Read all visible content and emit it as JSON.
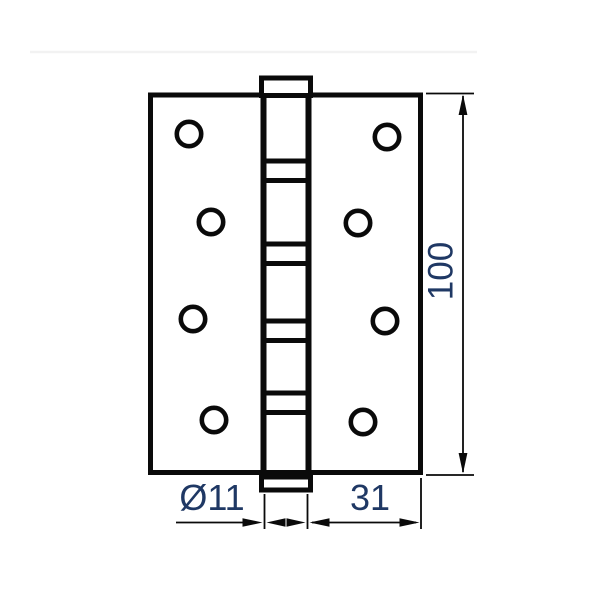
{
  "drawing": {
    "kind": "technical dimension drawing",
    "colors": {
      "background": "#ffffff",
      "ink": "#0a0a0a",
      "label": "#1f3864",
      "faint_divider": "#f2f2f2"
    },
    "dimension_labels": {
      "height": "100",
      "barrel_diameter": "Ø11",
      "leaf_width": "31"
    },
    "screw_holes": [
      [
        189,
        134
      ],
      [
        211,
        222
      ],
      [
        193,
        319
      ],
      [
        214,
        420
      ],
      [
        387,
        137
      ],
      [
        358,
        223
      ],
      [
        385,
        321
      ],
      [
        363,
        422
      ]
    ],
    "hole_radius": 12.2,
    "bearing_bands": [
      161,
      244,
      321,
      393
    ],
    "band_gap": 19.5
  }
}
